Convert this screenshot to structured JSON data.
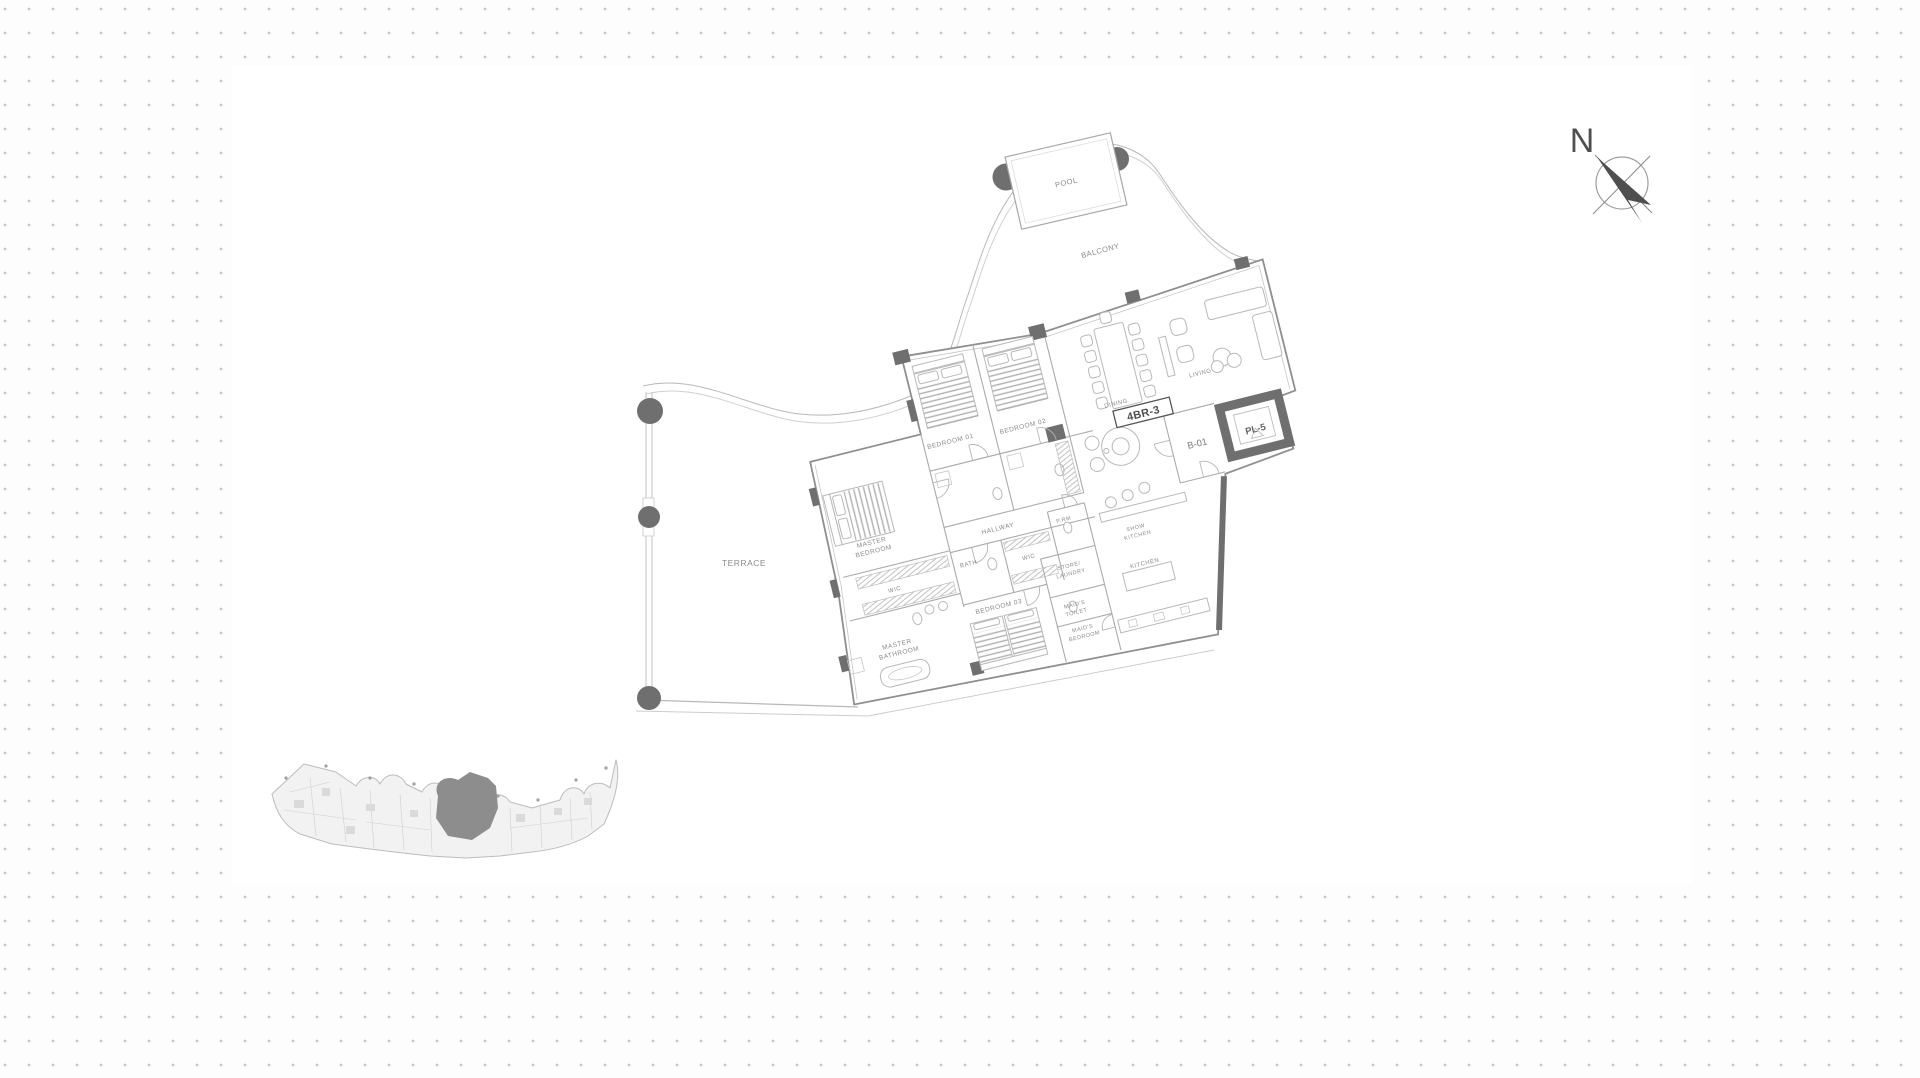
{
  "canvas": {
    "background": {
      "dot_color": "#c7c7c7",
      "dot_spacing_px": 24,
      "sheet_color": "#ffffff"
    }
  },
  "floorplan": {
    "unit_code": "4BR-3",
    "areas": {
      "pool": "POOL",
      "balcony": "BALCONY",
      "terrace": "TERRACE"
    },
    "rooms": {
      "bedroom01": "BEDROOM 01",
      "bedroom02": "BEDROOM 02",
      "bedroom03": "BEDROOM 03",
      "dining": "DINING",
      "living": "LIVING",
      "hallway": "HALLWAY",
      "bath": "BATH",
      "wic_master": "WIC",
      "wic_hall": "WIC",
      "powder_room": "P.RM",
      "store_laundry_line1": "STORE/",
      "store_laundry_line2": "LAUNDRY",
      "maids_toilet_line1": "MAID'S",
      "maids_toilet_line2": "TOILET",
      "maids_bedroom_line1": "MAID'S",
      "maids_bedroom_line2": "BEDROOM",
      "master_bedroom_line1": "MASTER",
      "master_bedroom_line2": "BEDROOM",
      "master_bathroom_line1": "MASTER",
      "master_bathroom_line2": "BATHROOM",
      "show_kitchen_line1": "SHOW",
      "show_kitchen_line2": "KITCHEN",
      "kitchen": "KITCHEN",
      "lobby": "B-01",
      "elevator": "PL-5"
    },
    "compass": {
      "north": "N"
    },
    "colors": {
      "wall_dark": "#6f6f6f",
      "line_gray": "#aaaaaa",
      "label_gray": "#8a8a8a",
      "keyplan_highlight": "#8d8d8d"
    }
  }
}
